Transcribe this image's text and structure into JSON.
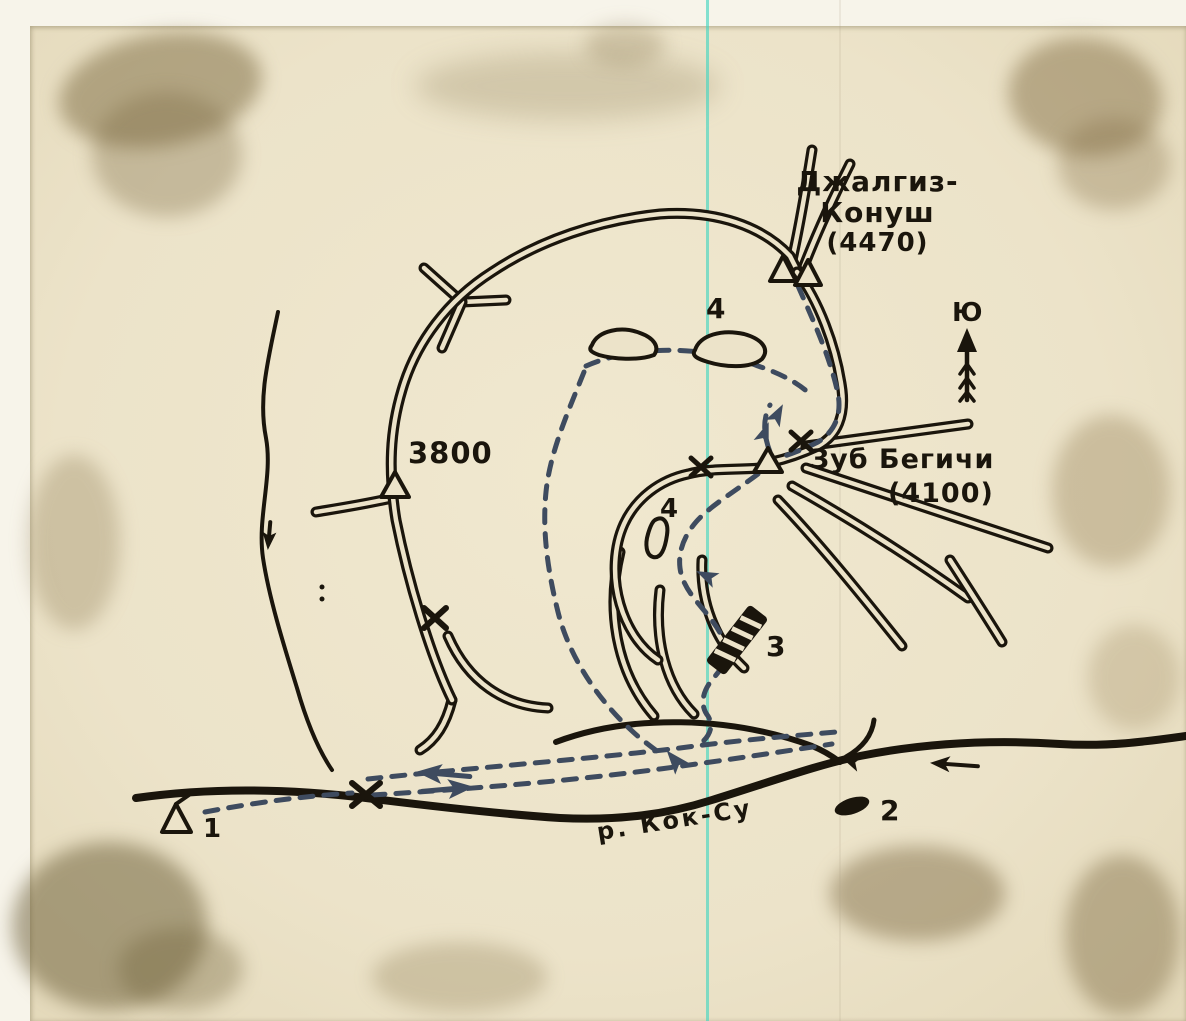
{
  "photo": {
    "labels": {
      "peak1_line1": "Джалгиз-",
      "peak1_line2": "Конуш",
      "peak1_elev": "(4470)",
      "peak2_name": "Зуб Бегичи",
      "peak2_elev": "(4100)",
      "spot_height": "3800",
      "river_name": "р. Кок-Су",
      "compass_south": "Ю",
      "marker_1": "1",
      "marker_2": "2",
      "marker_3": "3",
      "marker_4_upper": "4",
      "marker_4_lower": "4"
    },
    "icons": {
      "summit_marker": "double-open-triangle",
      "spot_marker": "open-triangle",
      "pass_marker": "x-mark",
      "camp_marker": "tent-triangle",
      "icefall_marker": "hatched-bar",
      "site_2_marker": "filled-oval",
      "direction_marker": "arrow-with-fletching"
    },
    "colors": {
      "paper": "#ece3c9",
      "ink": "#1a150c",
      "route": "#3e4b5f",
      "scan_line": "#45d5c0"
    }
  }
}
